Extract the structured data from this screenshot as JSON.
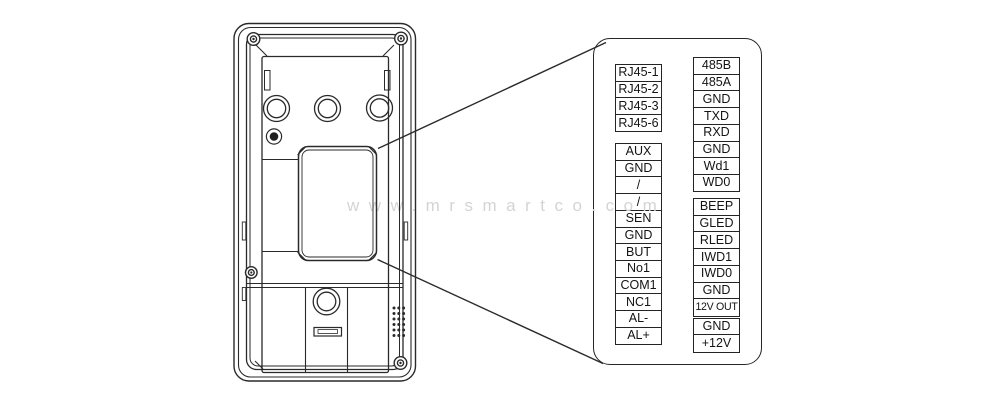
{
  "watermark": {
    "text": "www.mrsmartco.com"
  },
  "pinout": {
    "left_groups": [
      {
        "name": "rj45",
        "rows": [
          "RJ45-1",
          "RJ45-2",
          "RJ45-3",
          "RJ45-6"
        ]
      },
      {
        "name": "main",
        "rows": [
          "AUX",
          "GND",
          "/",
          "/",
          "SEN",
          "GND",
          "BUT",
          "No1",
          "COM1",
          "NC1",
          "AL-",
          "AL+"
        ]
      }
    ],
    "right_groups": [
      {
        "name": "comm",
        "rows": [
          "485B",
          "485A",
          "GND",
          "TXD",
          "RXD",
          "GND",
          "Wd1",
          "WD0"
        ]
      },
      {
        "name": "io",
        "rows": [
          "BEEP",
          "GLED",
          "RLED",
          "IWD1",
          "IWD0",
          "GND",
          "12V OUT"
        ]
      },
      {
        "name": "power",
        "rows": [
          "GND",
          "+12V"
        ]
      }
    ]
  },
  "colors": {
    "background": "#ffffff",
    "line": "#2a2a2a",
    "cell_border": "#242424",
    "watermark": "#d4d4d4"
  }
}
